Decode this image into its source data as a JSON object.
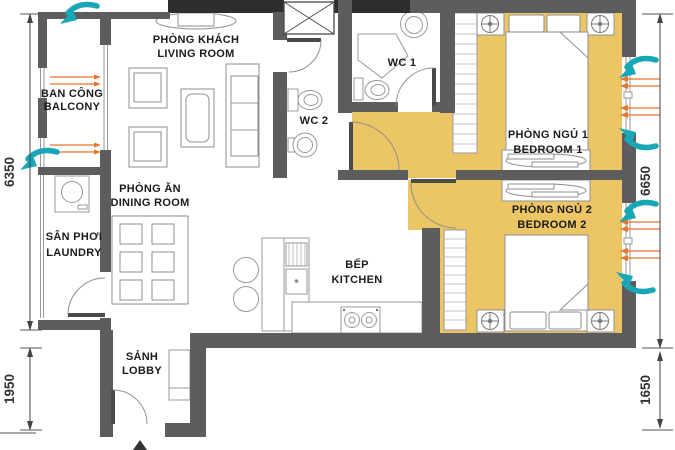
{
  "title": "apartment-floor-plan",
  "rooms": {
    "living": {
      "vi": "PHÒNG KHÁCH",
      "en": "LIVING ROOM"
    },
    "balcony": {
      "vi": "BAN CÔNG",
      "en": "BALCONY"
    },
    "laundry": {
      "vi": "SÂN PHƠI",
      "en": "LAUNDRY"
    },
    "dining": {
      "vi": "PHÒNG ĂN",
      "en": "DINING ROOM"
    },
    "wc1": "WC 1",
    "wc2": "WC 2",
    "bedroom1": {
      "vi": "PHÒNG NGỦ 1",
      "en": "BEDROOM 1"
    },
    "bedroom2": {
      "vi": "PHÒNG NGỦ 2",
      "en": "BEDROOM 2"
    },
    "kitchen": {
      "vi": "BẾP",
      "en": "KITCHEN"
    },
    "lobby": {
      "vi": "SẢNH",
      "en": "LOBBY"
    }
  },
  "dimensions": {
    "left_upper": "6350",
    "left_lower": "1950",
    "right_upper": "6650",
    "right_lower": "1650"
  },
  "colors": {
    "bedroom_highlight": "#ecc565",
    "wall": "#5d5d5d",
    "wall_dark": "#2e2e2e",
    "airflow_arrow": "#18a7b6",
    "vent_tick": "#e8742a"
  }
}
